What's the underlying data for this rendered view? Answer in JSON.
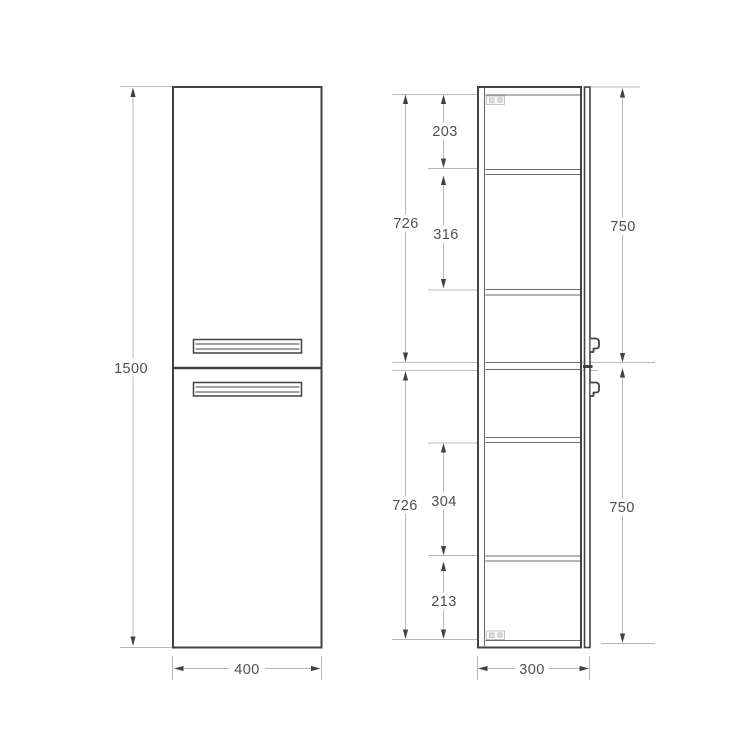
{
  "drawing_type": "cabinet-technical-drawing",
  "views": {
    "front": {
      "dims": {
        "height": "1500",
        "width": "400"
      }
    },
    "side": {
      "dims": {
        "depth": "300",
        "door_upper": "750",
        "door_lower": "750",
        "interior_upper": "726",
        "interior_lower": "726",
        "gap_top": "203",
        "gap_upper_mid": "316",
        "gap_lower_mid": "304",
        "gap_bottom": "213"
      }
    }
  },
  "colors": {
    "outline": "#424242",
    "inner_line": "#6a6a6a",
    "dim_line": "#b8b8b8",
    "label_text": "#4f4f4f",
    "hinge_detail": "#c4c4c4",
    "background": "#ffffff"
  }
}
